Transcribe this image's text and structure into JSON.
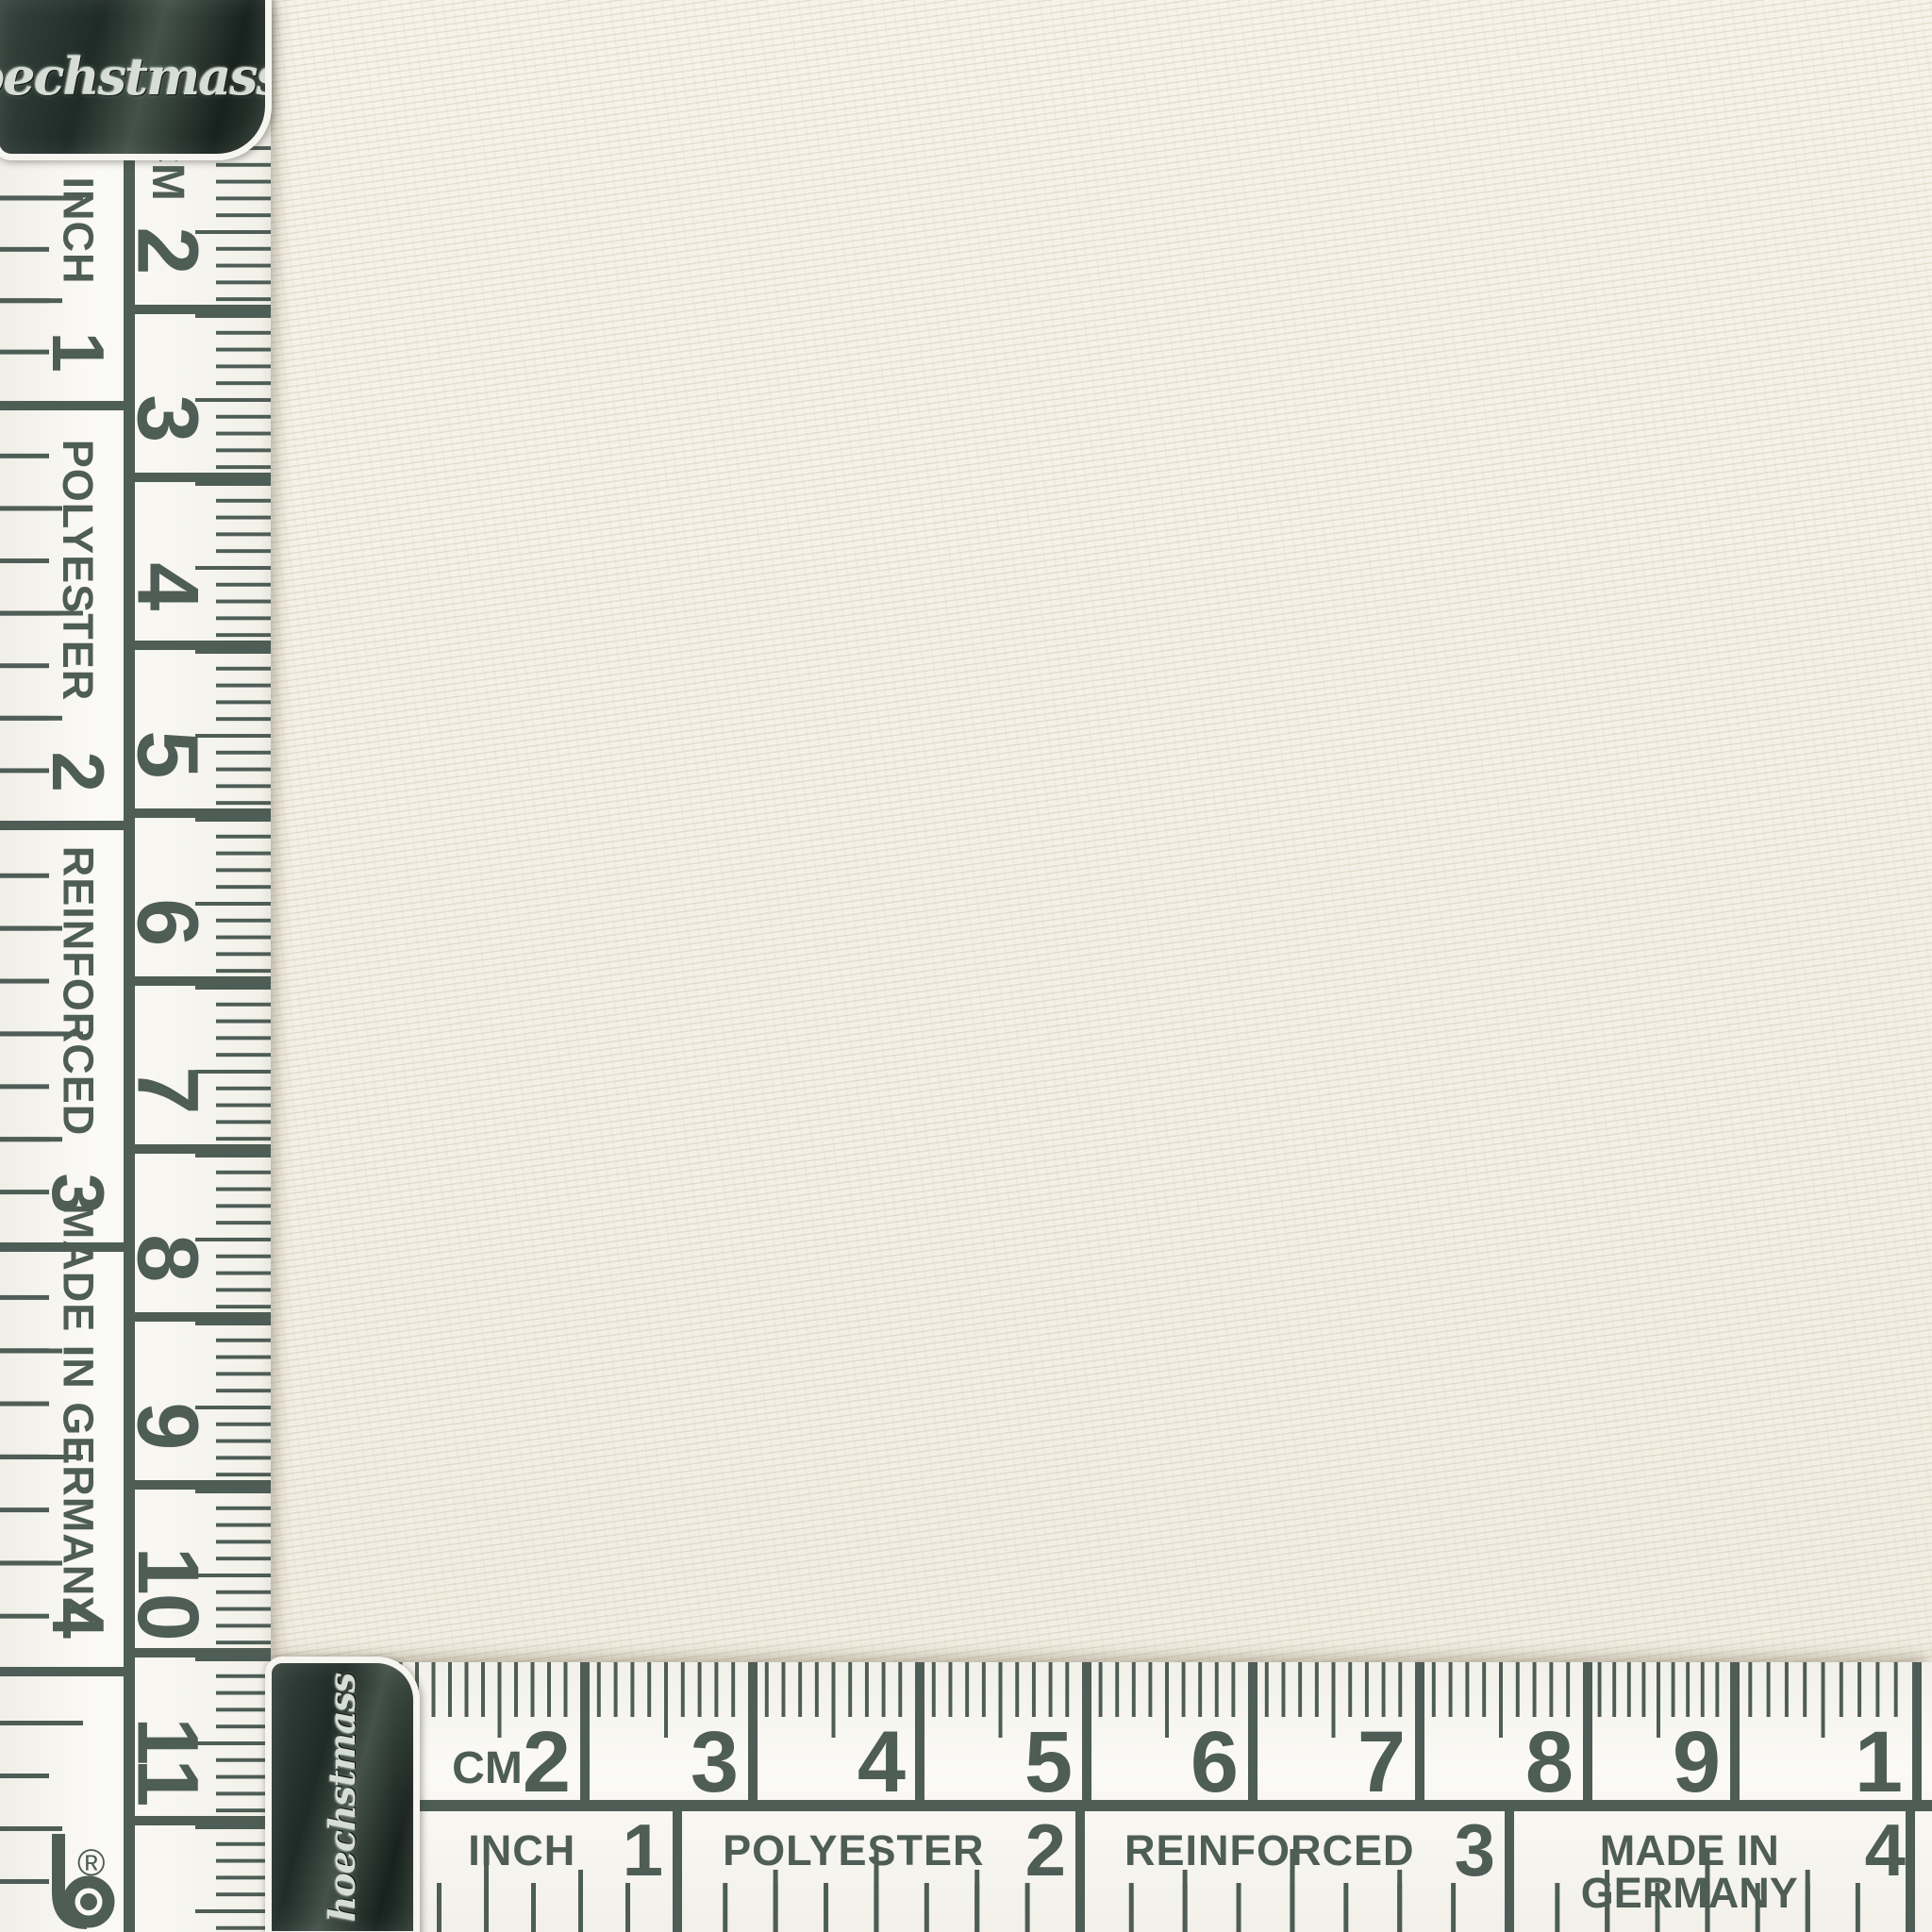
{
  "brand": {
    "script_name": "hoechstmass",
    "registered_mark": "®",
    "logo_letter": "b"
  },
  "colors": {
    "ink": "#4e5d56",
    "tape_body": "#f7f5f0",
    "fabric": "#f3efe5",
    "clip_dark": "#1f2b26",
    "emboss_silver": "#d6dcd6"
  },
  "vertical_tape": {
    "cm_scale": {
      "unit": "CM",
      "numbers": [
        "2",
        "3",
        "4",
        "5",
        "6",
        "7",
        "8",
        "9",
        "10",
        "11"
      ]
    },
    "inch_scale": {
      "segments": [
        {
          "label": "INCH",
          "number": "1"
        },
        {
          "label": "POLYESTER",
          "number": "2"
        },
        {
          "label": "REINFORCED",
          "number": "3"
        },
        {
          "label": "MADE IN GERMANY",
          "number": "4"
        }
      ]
    }
  },
  "horizontal_tape": {
    "cm_scale": {
      "unit": "CM",
      "numbers": [
        "2",
        "3",
        "4",
        "5",
        "6",
        "7",
        "8",
        "9",
        "1"
      ]
    },
    "inch_scale": {
      "segments": [
        {
          "label": "INCH",
          "number": "1"
        },
        {
          "label": "POLYESTER",
          "number": "2"
        },
        {
          "label": "REINFORCED",
          "number": "3"
        },
        {
          "label": "MADE IN GERMANY",
          "number": "4"
        }
      ]
    }
  }
}
